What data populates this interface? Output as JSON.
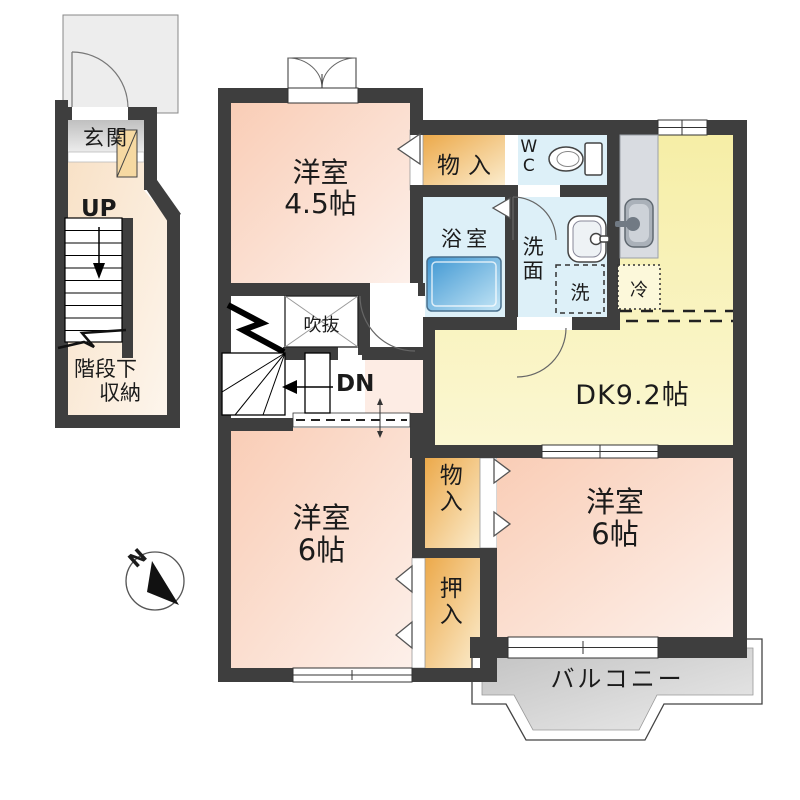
{
  "floor1": {
    "entrance": "玄関",
    "up": "UP",
    "under_stairs_line1": "階段下",
    "under_stairs_line2": "収納"
  },
  "floor2": {
    "room45_name": "洋室",
    "room45_size": "4.5帖",
    "closet_top": "物入",
    "wc": "WC",
    "bath": "浴室",
    "washroom": "洗面",
    "washer": "洗",
    "fridge": "冷",
    "dining_kitchen": "DK9.2帖",
    "void": "吹抜",
    "down": "DN",
    "room6_left_name": "洋室",
    "room6_left_size": "6帖",
    "closet_mid": "物入",
    "oshiire": "押入",
    "room6_right_name": "洋室",
    "room6_right_size": "6帖",
    "balcony": "バルコニー"
  },
  "compass": {
    "north": "N"
  },
  "colors": {
    "wall": "#3e3e3e",
    "room_pink": "#fad2bd",
    "dk_yellow": "#f7f0ac",
    "closet_orange": "#edb25c",
    "wet_blue": "#ddf0f8",
    "tub_blue": "#3e96d2",
    "balcony_gray": "#c5c5c5",
    "porch_gray": "#ededed"
  }
}
